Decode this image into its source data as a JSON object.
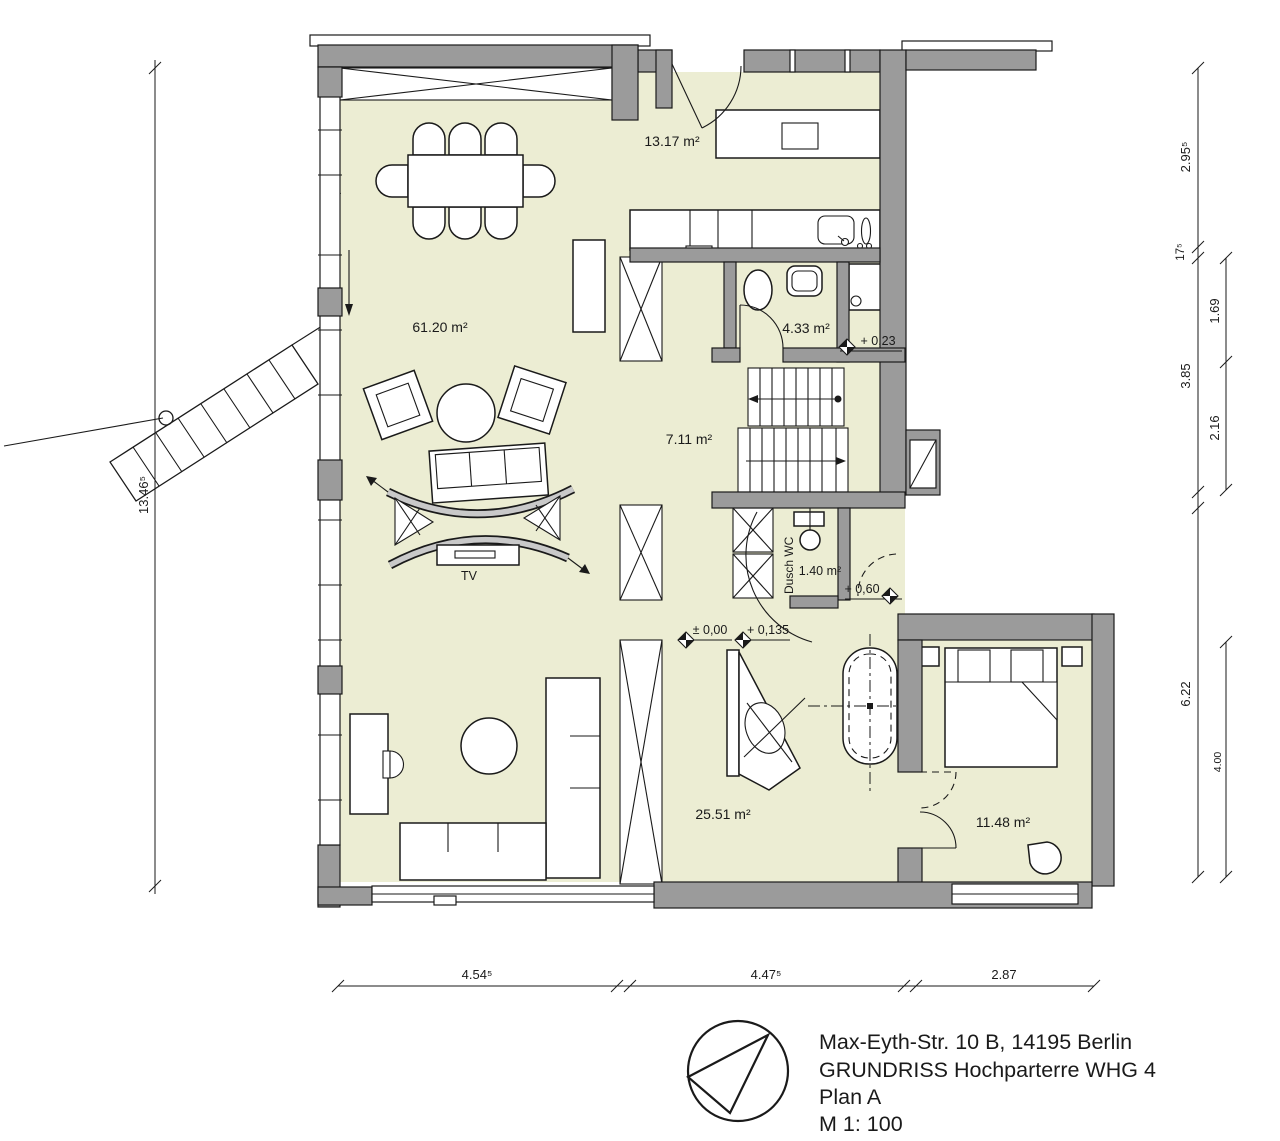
{
  "colors": {
    "floor": "#ecedd3",
    "wall": "#9b9b9b",
    "line": "#1a1a1a",
    "background": "#ffffff"
  },
  "rooms": {
    "living": "61.20 m²",
    "kitchen": "13.17 m²",
    "wc": "4.33 m²",
    "hall": "7.11 m²",
    "shower_wc_name": "Dusch WC",
    "shower_wc": "1.40 m²",
    "bath": "25.51 m²",
    "bedroom": "11.48 m²"
  },
  "labels": {
    "tv": "TV"
  },
  "levels": {
    "entry": "+ 0,23",
    "landing": "+ 0,60",
    "ground": "± 0,00",
    "bath": "+ 0,135"
  },
  "dims": {
    "left": "13.46⁵",
    "right_outer": [
      "2.95⁵",
      "17⁵",
      "3.85",
      "6.22"
    ],
    "right_inner": [
      "1.69",
      "2.16",
      "4.00"
    ],
    "bottom": [
      "4.54⁵",
      "4.47⁵",
      "2.87"
    ]
  },
  "title": {
    "address": "Max-Eyth-Str. 10 B, 14195 Berlin",
    "drawing": "GRUNDRISS Hochparterre WHG 4",
    "plan": "Plan A",
    "scale": "M 1: 100"
  }
}
